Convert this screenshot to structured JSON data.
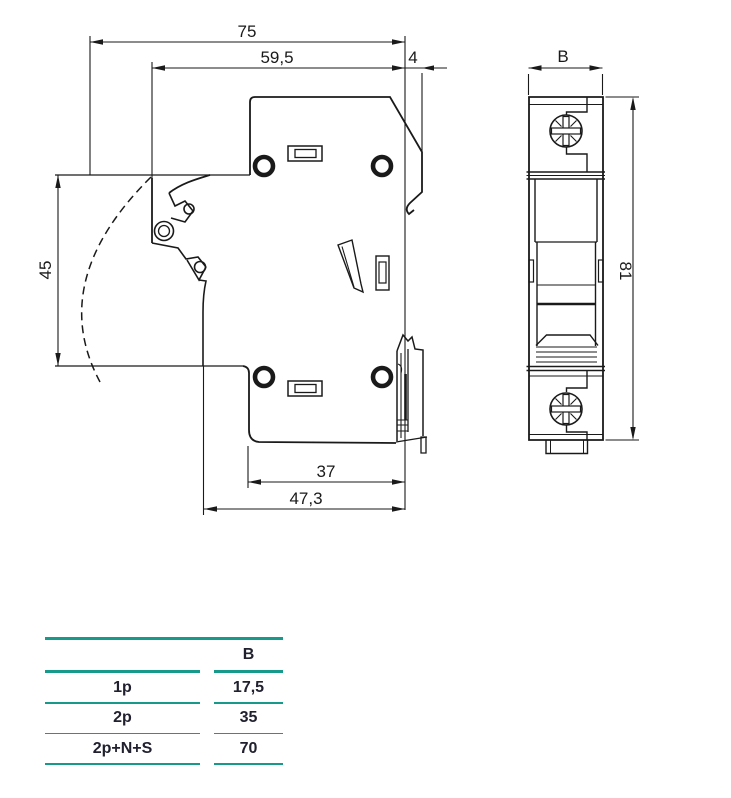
{
  "drawing": {
    "side_view": {
      "dims": {
        "total_width": "75",
        "body_width": "59,5",
        "rail_depth": "4",
        "lever_zone_height": "45",
        "base_width": "37",
        "base_total_width": "47,3"
      }
    },
    "front_view": {
      "dims": {
        "width": "B",
        "height": "81"
      }
    },
    "colors": {
      "line": "#1a1a1a"
    }
  },
  "table": {
    "header": {
      "col1": "",
      "col2": "B"
    },
    "rows": [
      {
        "label": "1p",
        "value": "17,5"
      },
      {
        "label": "2p",
        "value": "35"
      },
      {
        "label": "2p+N+S",
        "value": "70"
      }
    ],
    "accent_color": "#17998c",
    "text_color": "#20202f"
  }
}
